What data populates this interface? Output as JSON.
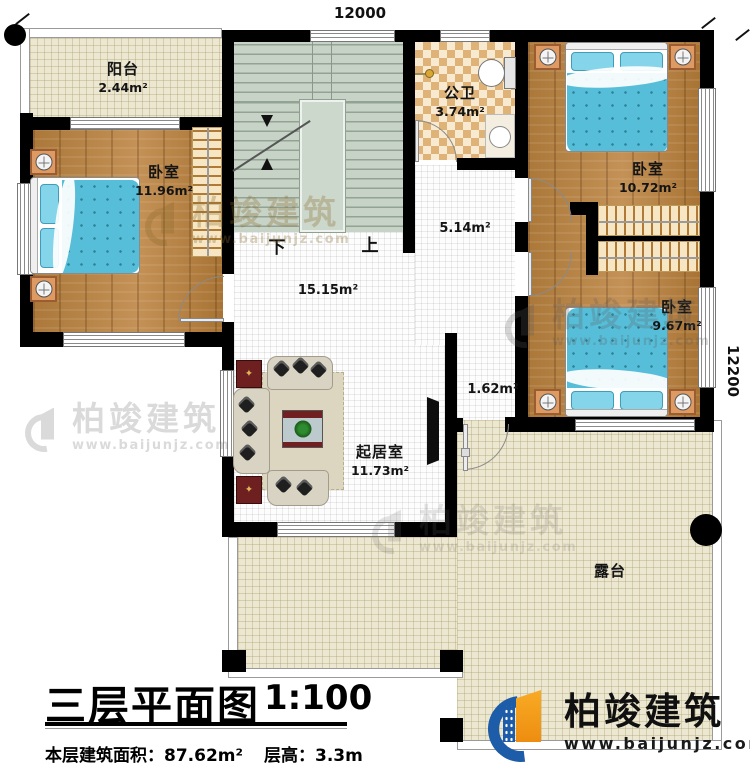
{
  "dimensions": {
    "top": "12000",
    "right": "12200"
  },
  "rooms": {
    "balcony": {
      "name": "阳台",
      "area": "2.44m²"
    },
    "bedroom1": {
      "name": "卧室",
      "area": "11.96m²"
    },
    "bathroom": {
      "name": "公卫",
      "area": "3.74m²"
    },
    "bedroom2": {
      "name": "卧室",
      "area": "10.72m²"
    },
    "bedroom3": {
      "name": "卧室",
      "area": "9.67m²"
    },
    "living": {
      "name": "起居室",
      "area": "11.73m²"
    },
    "terrace": {
      "name": "露台"
    }
  },
  "halls": {
    "hall_main": "15.15m²",
    "hall_upper": "5.14m²",
    "hall_side": "1.62m²"
  },
  "stairs": {
    "down": "下",
    "up": "上"
  },
  "title_block": {
    "title": "三层平面图",
    "scale": "1:100",
    "area_info": "本层建筑面积：87.62m²",
    "floor_height": "层高：3.3m"
  },
  "watermark": {
    "brand": "柏竣建筑",
    "url": "www.baijunjz.com"
  }
}
